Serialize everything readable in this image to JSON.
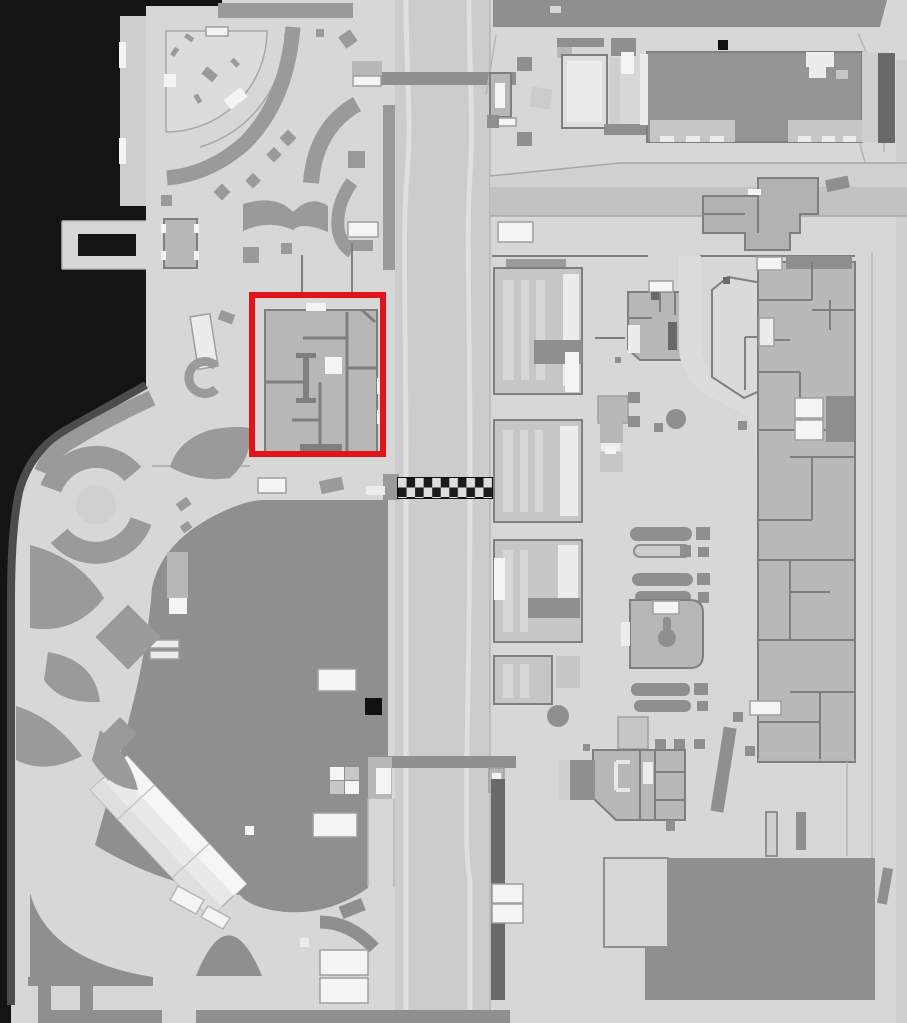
{
  "colors": {
    "water": "#141414",
    "shore": "#4c4c4c",
    "land": "#d7d7d7",
    "panel": "#cfcfcf",
    "road": "#cccccc",
    "lane": "#e0e0e0",
    "band": "#c2c2c2",
    "bandlt": "#d0d0d0",
    "park": "#9a9a9a",
    "plaza": "#8f8f8f",
    "bldg": "#b7b7b7",
    "bldg2": "#c6c6c6",
    "hall": "#949494",
    "wall": "#7f7f7f",
    "dark": "#696969",
    "white": "#f4f4f4",
    "off": "#ececec",
    "black": "#101010",
    "red": "#e2131b",
    "chkA": "#1b1b1b",
    "chkB": "#dedede",
    "fan": "#dcdcdc"
  },
  "highlight": {
    "x": 252,
    "y": 295,
    "width": 131,
    "height": 159
  },
  "markers": {
    "checkered_strip": {
      "x": 398,
      "y": 478,
      "width": 94,
      "height": 20,
      "rows": 2,
      "cols": 11
    },
    "black_square_plaza": {
      "x": 365,
      "y": 698,
      "size": 17
    },
    "black_square_hall": {
      "x": 718,
      "y": 40,
      "size": 10
    }
  }
}
